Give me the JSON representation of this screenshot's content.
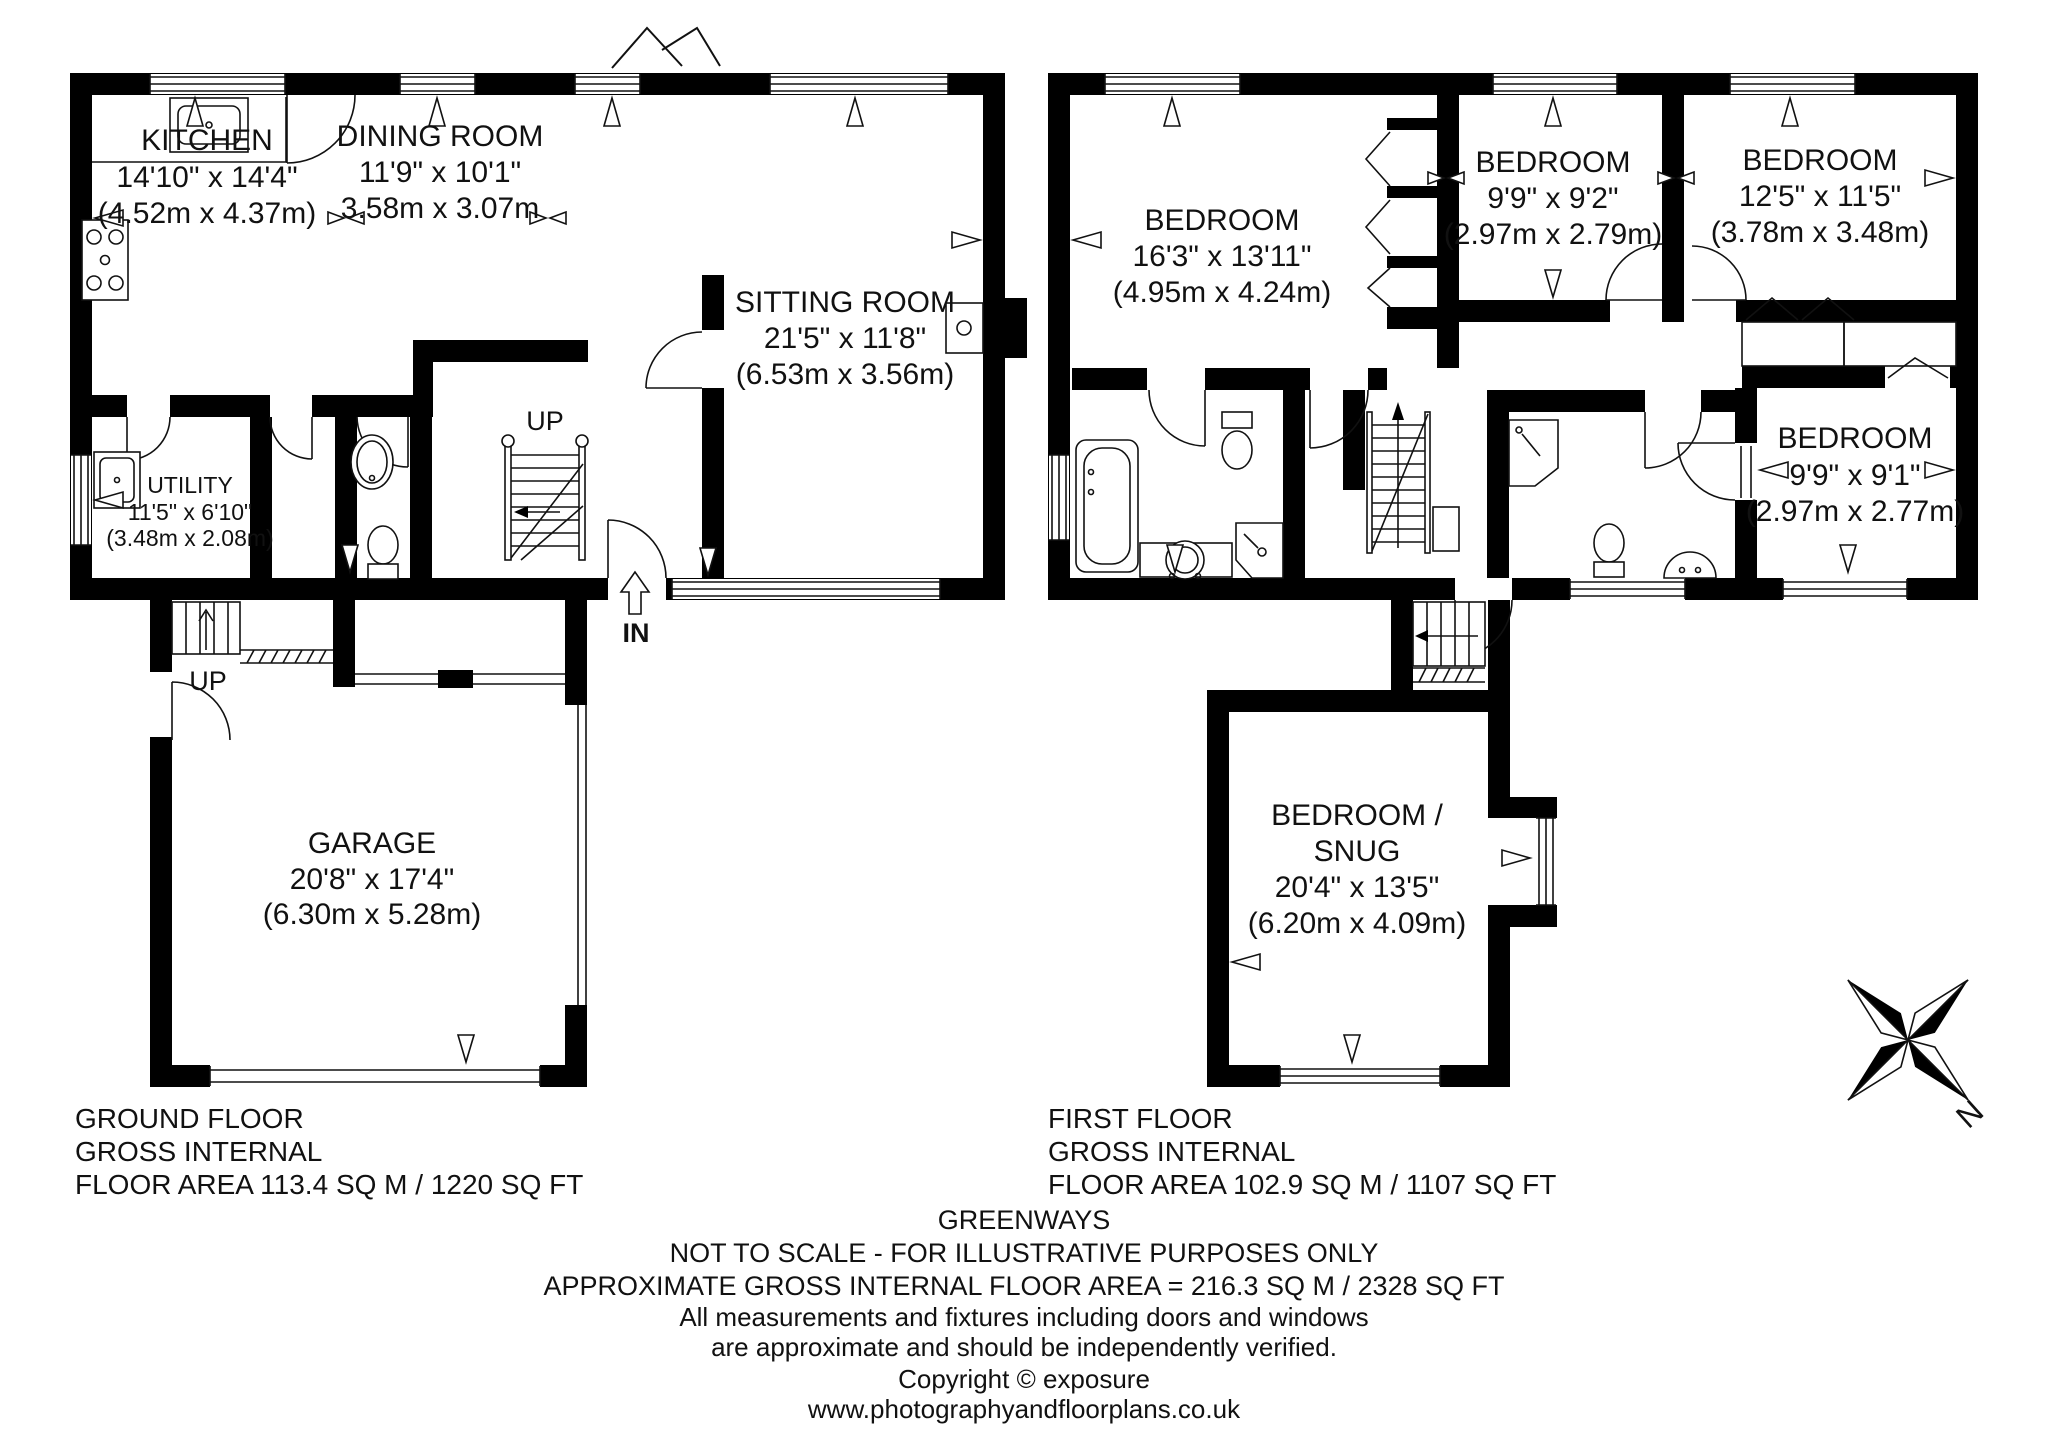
{
  "page": {
    "background": "#ffffff"
  },
  "colors": {
    "wall": "#000000",
    "line": "#111111",
    "text": "#111111"
  },
  "ground_floor": {
    "title_lines": [
      "GROUND FLOOR",
      "GROSS INTERNAL",
      "FLOOR AREA 113.4 SQ M / 1220 SQ FT"
    ],
    "rooms": {
      "kitchen": {
        "name": "KITCHEN",
        "size_ft": "14'10\" x 14'4\"",
        "size_m": "(4.52m x 4.37m)"
      },
      "dining_room": {
        "name": "DINING ROOM",
        "size_ft": "11'9\" x 10'1\"",
        "size_m": "3.58m x 3.07m"
      },
      "sitting_room": {
        "name": "SITTING ROOM",
        "size_ft": "21'5\" x 11'8\"",
        "size_m": "(6.53m x 3.56m)"
      },
      "utility": {
        "name": "UTILITY",
        "size_ft": "11'5\" x 6'10\"",
        "size_m": "(3.48m x 2.08m)"
      },
      "garage": {
        "name": "GARAGE",
        "size_ft": "20'8\" x 17'4\"",
        "size_m": "(6.30m x 5.28m)"
      }
    },
    "labels": {
      "stairs_up": "UP",
      "garage_up": "UP",
      "entrance": "IN"
    }
  },
  "first_floor": {
    "title_lines": [
      "FIRST FLOOR",
      "GROSS INTERNAL",
      "FLOOR AREA 102.9 SQ M / 1107 SQ FT"
    ],
    "rooms": {
      "bedroom_master": {
        "name": "BEDROOM",
        "size_ft": "16'3\" x 13'11\"",
        "size_m": "(4.95m x 4.24m)"
      },
      "bedroom_2": {
        "name": "BEDROOM",
        "size_ft": "9'9\" x 9'2\"",
        "size_m": "(2.97m x 2.79m)"
      },
      "bedroom_3": {
        "name": "BEDROOM",
        "size_ft": "12'5\" x 11'5\"",
        "size_m": "(3.78m x 3.48m)"
      },
      "bedroom_4": {
        "name": "BEDROOM",
        "size_ft": "9'9\" x 9'1\"",
        "size_m": "(2.97m x 2.77m)"
      },
      "bedroom_snug": {
        "name_line_1": "BEDROOM /",
        "name_line_2": "SNUG",
        "size_ft": "20'4\" x 13'5\"",
        "size_m": "(6.20m x 4.09m)"
      }
    }
  },
  "footer": {
    "property_name": "GREENWAYS",
    "scale_note": "NOT TO SCALE - FOR ILLUSTRATIVE PURPOSES ONLY",
    "total_area": "APPROXIMATE GROSS INTERNAL FLOOR AREA = 216.3 SQ M / 2328 SQ FT",
    "disclaimer_line_1": "All measurements and fixtures including doors and windows",
    "disclaimer_line_2": "are approximate and should be independently verified.",
    "copyright": "Copyright ©  exposure",
    "website": "www.photographyandfloorplans.co.uk"
  },
  "compass": {
    "north": "N"
  }
}
